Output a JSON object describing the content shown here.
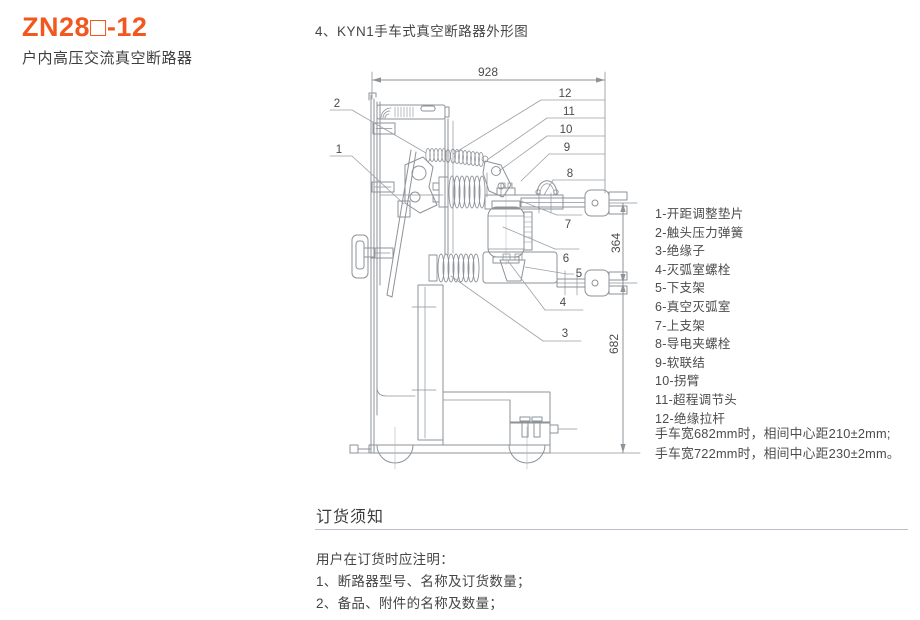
{
  "header": {
    "model": "ZN28□-12",
    "subtitle": "户内高压交流真空断路器"
  },
  "figure": {
    "title": "4、KYN1手车式真空断路器外形图",
    "dim_width": "928",
    "dim_pole_spacing": "364",
    "dim_height": "682",
    "callouts": [
      "1",
      "2",
      "3",
      "4",
      "5",
      "6",
      "7",
      "8",
      "9",
      "10",
      "11",
      "12"
    ],
    "parts": [
      "1-开距调整垫片",
      "2-触头压力弹簧",
      "3-绝缘子",
      "4-灭弧室螺栓",
      "5-下支架",
      "6-真空灭弧室",
      "7-上支架",
      "8-导电夹螺栓",
      "9-软联结",
      "10-拐臂",
      "11-超程调节头",
      "12-绝缘拉杆"
    ],
    "notes": [
      "手车宽682mm时，相间中心距210±2mm;",
      "手车宽722mm时，相间中心距230±2mm。"
    ]
  },
  "ordering": {
    "title": "订货须知",
    "intro": "用户在订货时应注明：",
    "items": [
      "1、断路器型号、名称及订货数量；",
      "2、备品、附件的名称及数量；"
    ]
  },
  "colors": {
    "accent": "#f2571f",
    "drawing_line": "#8e9398"
  }
}
